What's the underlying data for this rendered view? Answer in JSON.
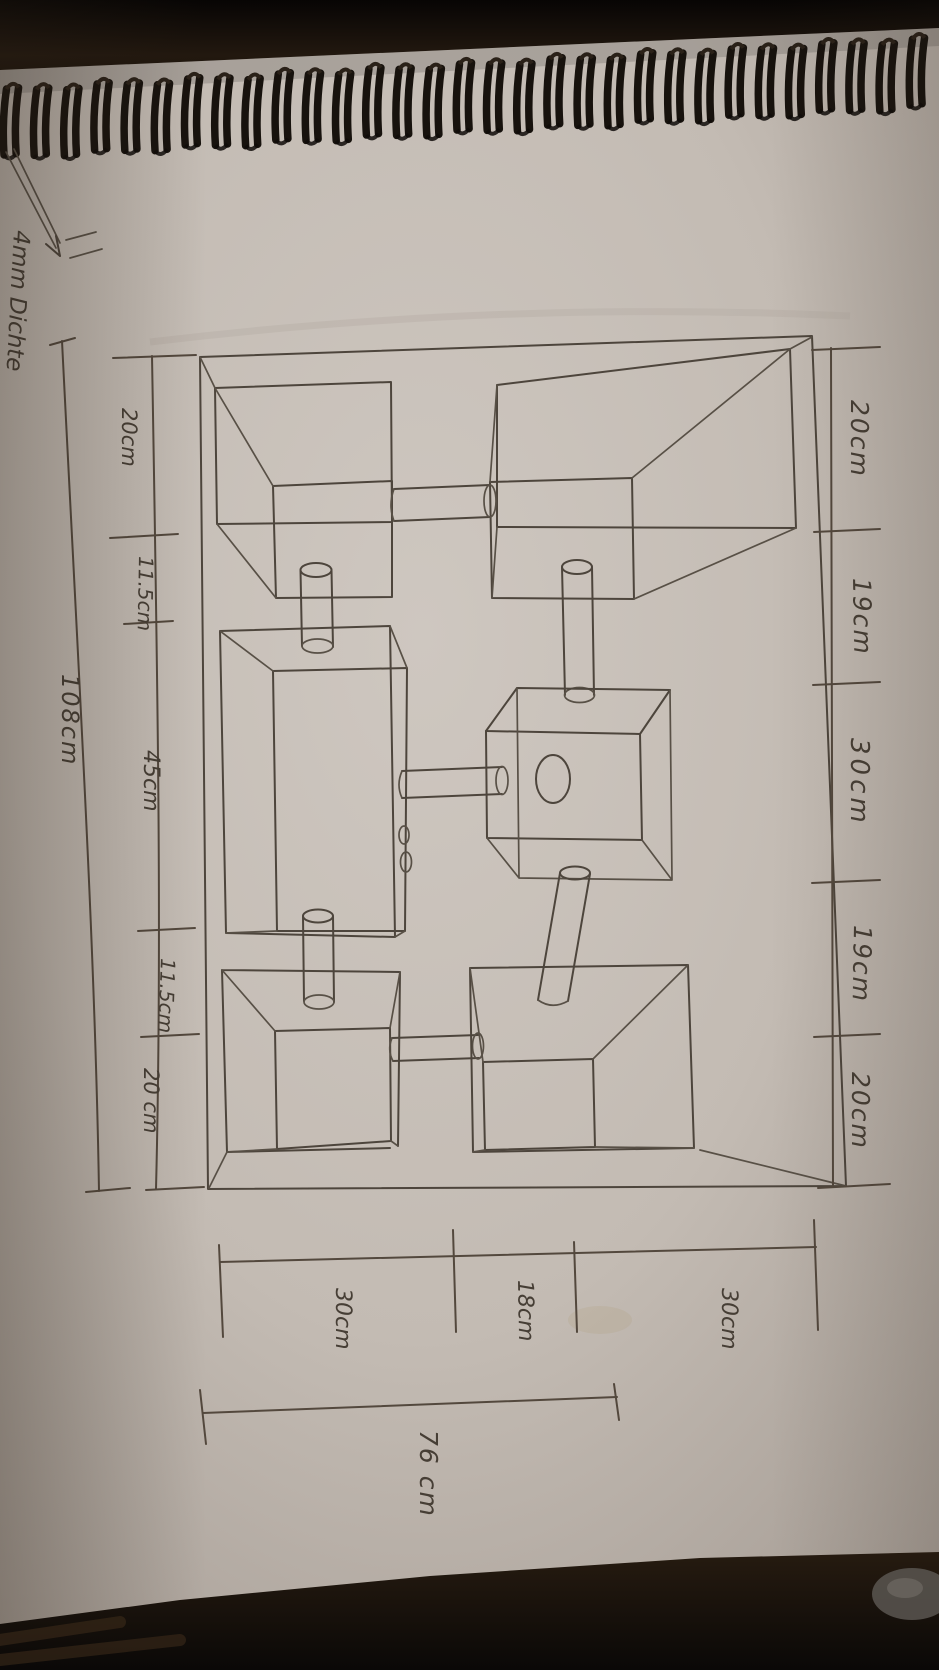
{
  "photo": {
    "annotation": "4mm Dichte",
    "dims_left_total": "108cm",
    "dims_left": [
      "20cm",
      "11.5cm",
      "45cm",
      "11.5cm",
      "20 cm"
    ],
    "dims_right": [
      "20cm",
      "19cm",
      "30cm",
      "19cm",
      "20cm"
    ],
    "dims_bottom": [
      "30cm",
      "18cm",
      "30cm"
    ],
    "dims_bottom_total": "76 cm",
    "colors": {
      "ink": "#4d453c",
      "paper": "#c3bbb3",
      "background": "#0c0a08"
    }
  }
}
